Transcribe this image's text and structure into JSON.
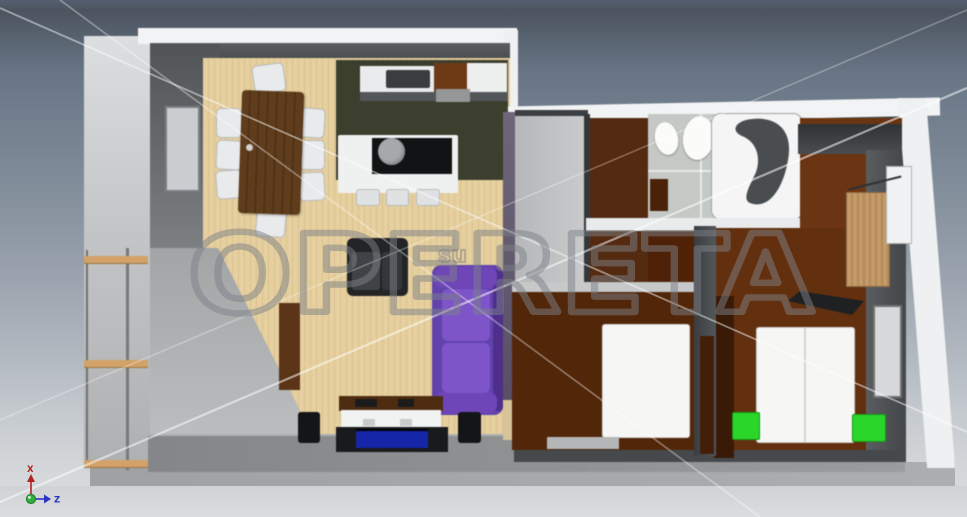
{
  "watermark": {
    "text": "OPERETA",
    "subtext": "su"
  },
  "axis_gizmo": {
    "x_label": "X",
    "z_label": "Z"
  },
  "colors": {
    "wood_floor": "#e6d0a0",
    "wood_floor_stripe": "#d9c18c",
    "kitchen_floor": "#3c3f2e",
    "tile_floor": "#c5c9c5",
    "hallway_floor": "#542a10",
    "hall_extension_floor": "#4f2208",
    "bedroom_middle_floor": "#522609",
    "bedroom_right_floor": "#63300f",
    "bedroom_right_upper_floor": "#6b3513",
    "sofa_purple": "#6243ae",
    "sofa_cushion_purple": "#7e55c8",
    "armchair_dark": "#222426",
    "dining_table_brown": "#5f3d1c",
    "kitchen_cabinet_brown": "#6e3a16",
    "sideboard_brown": "#5c3418",
    "wardrobe_tan": "#c49a68",
    "bed_white": "#f6f6f4",
    "nightstand_green": "#2bd62b",
    "tv_blue": "#1626a8",
    "outer_wall_white": "#f2f3f4",
    "inner_wall_dark": "#46494c",
    "balcony_wood": "#d2a269",
    "watermark_stroke": "#7d8188",
    "axis_x_red": "#b22421",
    "axis_z_blue": "#2a35c0",
    "axis_origin_green": "#2fae3d"
  }
}
